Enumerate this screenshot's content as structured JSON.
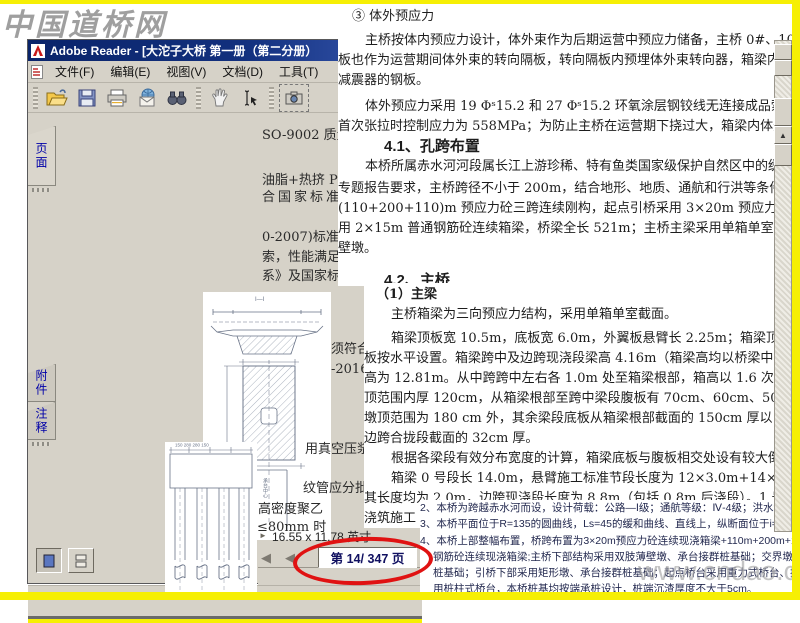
{
  "watermark_top": "中国道桥网",
  "watermark_bottom": "www.cndao.com",
  "window": {
    "title": "Adobe Reader - [大沱子大桥 第一册（第二分册）",
    "menus": [
      "文件(F)",
      "编辑(E)",
      "视图(V)",
      "文档(D)",
      "工具(T)"
    ],
    "toolbar_icons": [
      "open-file",
      "save",
      "print",
      "email",
      "search-binoculars",
      "hand-tool",
      "text-select",
      "snapshot-camera"
    ]
  },
  "sidebar": {
    "options_label": "选项",
    "options_arrow": "▼",
    "close_label": "×",
    "tabs": [
      {
        "label": "页面"
      },
      {
        "label": "附件"
      },
      {
        "label": "注释"
      }
    ],
    "thumbnails": [
      {
        "page": "37"
      },
      {
        "page": "38"
      },
      {
        "page": "39"
      }
    ]
  },
  "pane": {
    "fragments": [
      "SO-9002 质量",
      "油脂+热挤 PE",
      "合国家标准",
      "0-2007)标准。",
      "索，性能满足",
      "系》及国家标",
      "须符合《碳",
      "-2016)的规",
      "用真空压浆",
      "纹管应分批",
      "高密度聚乙",
      "≤80mm 时"
    ]
  },
  "statusbar": {
    "page_size": "16.55 x 11.78 英寸",
    "page_indicator": "第 14/ 347 页",
    "prev_arrow": "◀",
    "hscroll_arrow": "►"
  },
  "document": {
    "lines": [
      "③ 体外预应力",
      "主桥按体内预应力设计，体外束作为后期运营中预应力储备，主桥 0#、10#、20#梁段横隔",
      "板也作为运营期间体外束的转向隔板，转向隔板内预埋体外束转向器，箱梁内预埋固定体外束",
      "减震器的钢板。",
      "体外预应力采用 19 Φˢ15.2 和 27 Φˢ15.2 环氧涂层钢铰线无连接成品索，热挤 HDPE 防护，",
      "首次张拉时控制应力为 558MPa；为防止主桥在运营期下挠过大，箱梁内体外束可进行再次张拉，",
      "4.1、孔跨布置",
      "本桥所属赤水河河段属长江上游珍稀、特有鱼类国家级保护自然区中的缓冲区。",
      "专题报告要求，主桥跨径不小于 200m，结合地形、地质、通航和行洪等条件，主桥桥",
      "(110+200+110)m 预应力砼三跨连续刚构，起点引桥采用 3×20m 预应力砼连续箱梁，止",
      "用 2×15m 普通钢筋砼连续箱梁，桥梁全长 521m；主桥主梁采用单箱单室截面，主墩采",
      "壁墩。",
      "4.2、主桥",
      "（1）主梁",
      "主桥箱梁为三向预应力结构，采用单箱单室截面。",
      "箱梁顶板宽 10.5m，底板宽 6.0m，外翼板悬臂长 2.25m；箱梁顶板设置成 2%双向",
      "板按水平设置。箱梁跨中及边跨现浇段梁高 4.16m（箱梁高均以桥梁中心线为准），墩",
      "高为 12.81m。从中跨跨中左右各 1.0m 处至箱梁根部，箱高以 1.6 次抛物线变化。箱梁",
      "顶范围内厚 120cm，从箱梁根部至跨中梁段腹板有 70cm、60cm、50 cm 三种厚度。箱梁",
      "墩顶范围为 180 cm 外，其余梁段底板从箱梁根部截面的 150cm 厚以 1.5 次抛物线渐变",
      "边跨合拢段截面的 32cm 厚。",
      "根据各梁段有效分布宽度的计算，箱梁底板与腹板相交处设有较大倒角。",
      "箱梁 0 号段长 14.0m，悬臂施工标准节段长度为 12×3.0m+14×4.0m，全桥共设 3",
      "其长度均为 2.0m，边跨现浇段长度为 8.8m（包括 0.8m 后浇段）。1 号～26 号梁段采用",
      "浇筑施工"
    ]
  },
  "notes": {
    "lines": [
      "2、本桥为跨越赤水河而设，设计荷载：公路—Ⅰ级；通航等级：Ⅳ-4级；洪水频率：1/100。",
      "3、本桥平面位于R=135的圆曲线，Ls=45的缓和曲线、直线上，纵断面位于i=2.95%的升坡段上；墩台按路线法线布置。",
      "4、本桥上部整幅布置，桥跨布置为3×20m预应力砼连续现浇箱梁+110m+200m+110m连续刚构+2×15m普通",
      "钢筋砼连续现浇箱梁;主桥下部结构采用双肢薄壁墩、承台接群桩基础；交界墩采用实心墩、承台接群",
      "桩基础；引桥下部采用矩形墩、承台接群桩基础；起点桥台采用重力式桥台、扩大基础，止点桥台采",
      "用桩柱式桥台，本桥桩基均按端承桩设计，桩端沉渣厚度不大于5cm。"
    ]
  },
  "colors": {
    "accent_yellow": "#f6ef04",
    "titlebar_blue": "#0a246a",
    "chrome_gray": "#d6d2c8",
    "ellipse_red": "#e01212",
    "tab_blue": "#0000a8"
  }
}
